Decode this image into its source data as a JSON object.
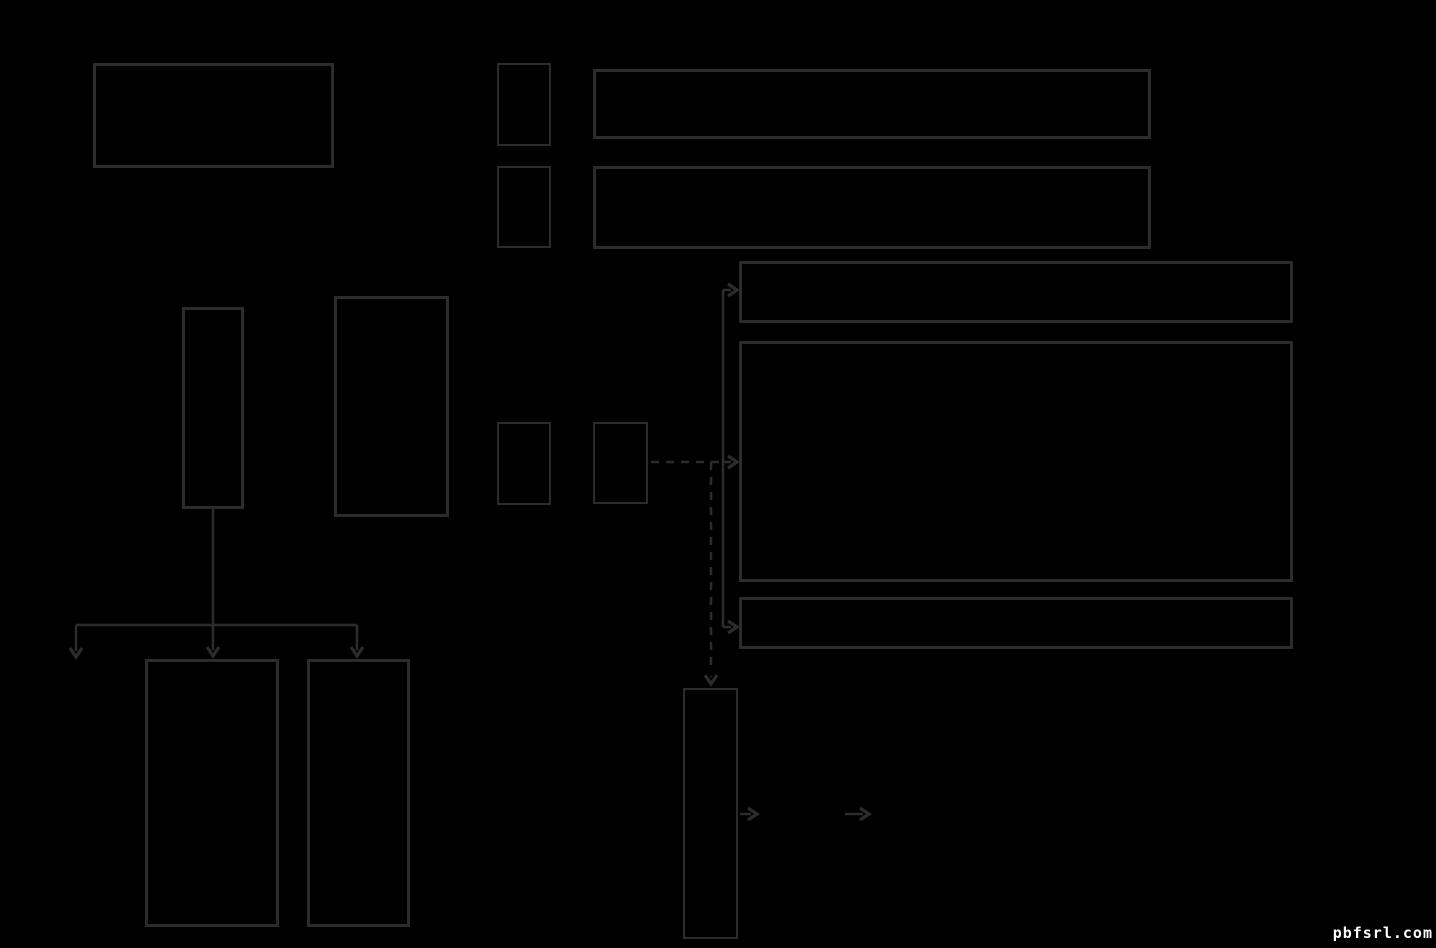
{
  "canvas": {
    "width": 1436,
    "height": 948,
    "background": "#000000"
  },
  "style": {
    "stroke_color": "#2c2c2c",
    "line_width": 2.5,
    "arrowhead_width": 3.2,
    "dash_pattern": "8 7"
  },
  "watermark": {
    "text": "pbfsrl.com",
    "color": "#ffffff"
  },
  "diagram": {
    "nodes": [
      {
        "id": "top-left-large",
        "x": 93,
        "y": 63,
        "w": 241,
        "h": 105,
        "border": 3
      },
      {
        "id": "small-row1",
        "x": 497,
        "y": 63,
        "w": 54,
        "h": 83,
        "border": 2
      },
      {
        "id": "wide-row1",
        "x": 593,
        "y": 69,
        "w": 558,
        "h": 70,
        "border": 3
      },
      {
        "id": "small-row2",
        "x": 497,
        "y": 166,
        "w": 54,
        "h": 82,
        "border": 2
      },
      {
        "id": "wide-row2",
        "x": 593,
        "y": 166,
        "w": 558,
        "h": 83,
        "border": 3
      },
      {
        "id": "right-banner",
        "x": 739,
        "y": 261,
        "w": 554,
        "h": 62,
        "border": 3
      },
      {
        "id": "right-large",
        "x": 739,
        "y": 341,
        "w": 554,
        "h": 241,
        "border": 3
      },
      {
        "id": "tall-narrow",
        "x": 182,
        "y": 307,
        "w": 62,
        "h": 202,
        "border": 3
      },
      {
        "id": "tall-medium",
        "x": 334,
        "y": 296,
        "w": 115,
        "h": 221,
        "border": 3
      },
      {
        "id": "small-row3",
        "x": 497,
        "y": 422,
        "w": 54,
        "h": 83,
        "border": 2
      },
      {
        "id": "small-row3b",
        "x": 593,
        "y": 422,
        "w": 55,
        "h": 82,
        "border": 2
      },
      {
        "id": "right-strip",
        "x": 739,
        "y": 597,
        "w": 554,
        "h": 52,
        "border": 3
      },
      {
        "id": "bottom-narrow",
        "x": 683,
        "y": 688,
        "w": 55,
        "h": 251,
        "border": 2
      },
      {
        "id": "bottom-left-1",
        "x": 145,
        "y": 659,
        "w": 134,
        "h": 268,
        "border": 3
      },
      {
        "id": "bottom-left-2",
        "x": 307,
        "y": 659,
        "w": 103,
        "h": 268,
        "border": 3
      }
    ],
    "connectors": {
      "solid": [
        "M 213 509 L 213 625",
        "M 76 625 L 357 625",
        "M 76 625 L 76 651",
        "M 213 625 L 213 650",
        "M 357 625 L 357 650",
        "M 723 290 L 723 627",
        "M 723 290 L 731 290",
        "M 723 462 L 731 462",
        "M 723 627 L 731 627",
        "M 711 676 L 711 677",
        "M 740 814 L 751 814",
        "M 845 814 L 863 814"
      ],
      "dashed": [
        "M 651 462 L 719 462",
        "M 711 462 L 711 672"
      ],
      "arrowheads": [
        {
          "x": 76,
          "y": 657,
          "dir": "down"
        },
        {
          "x": 213,
          "y": 656,
          "dir": "down"
        },
        {
          "x": 357,
          "y": 656,
          "dir": "down"
        },
        {
          "x": 737,
          "y": 290,
          "dir": "right"
        },
        {
          "x": 737,
          "y": 462,
          "dir": "right"
        },
        {
          "x": 737,
          "y": 627,
          "dir": "right"
        },
        {
          "x": 711,
          "y": 684,
          "dir": "down"
        },
        {
          "x": 757,
          "y": 814,
          "dir": "right"
        },
        {
          "x": 869,
          "y": 814,
          "dir": "right"
        }
      ]
    }
  }
}
